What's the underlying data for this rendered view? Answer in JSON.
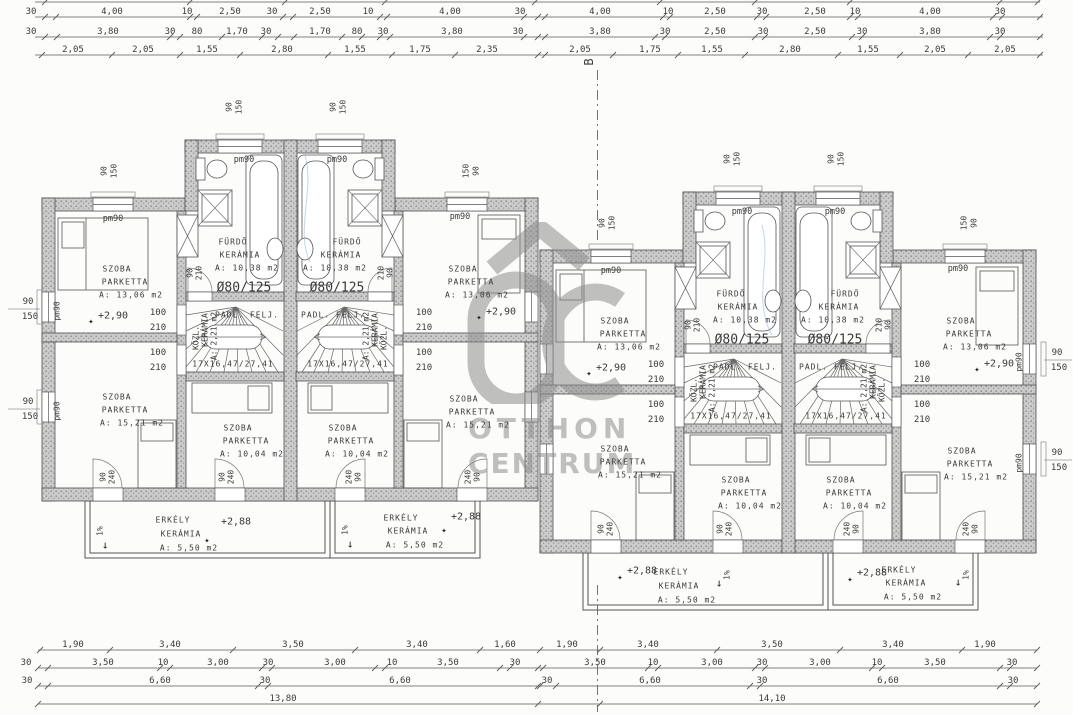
{
  "watermark": {
    "line1": "OTTHON",
    "line2": "CENTRUM"
  },
  "labels": [
    [
      "SZOBA",
      117,
      269,
      "rm"
    ],
    [
      "PARKETTA",
      125,
      282,
      "rm"
    ],
    [
      "A: 13,06 m2",
      131,
      295,
      "rm"
    ],
    [
      "+2,90",
      113,
      316,
      "lvl"
    ],
    [
      "✦",
      91,
      322,
      "star"
    ],
    [
      "SZOBA",
      117,
      397,
      "rm"
    ],
    [
      "PARKETTA",
      125,
      410,
      "rm"
    ],
    [
      "A: 15,21 m2",
      132,
      423,
      "rm"
    ],
    [
      "SZOBA",
      238,
      428,
      "rm"
    ],
    [
      "PARKETTA",
      246,
      441,
      "rm"
    ],
    [
      "A: 10,04 m2",
      252,
      454,
      "rm"
    ],
    [
      "FÜRDŐ",
      233,
      242,
      "rm"
    ],
    [
      "KERÁMIA",
      240,
      255,
      "rm"
    ],
    [
      "A: 10,38 m2",
      247,
      268,
      "rm"
    ],
    [
      "Ø80/125",
      244,
      288,
      "big"
    ],
    [
      "PADL. FELJ.",
      247,
      315,
      "rm"
    ],
    [
      "17X16,47/27,41",
      233,
      364,
      "rm"
    ],
    [
      "KÖZL.",
      196,
      338,
      "rot"
    ],
    [
      "KERÁMIA",
      205,
      330,
      "rot"
    ],
    [
      "A: 2,21 m2",
      214,
      336,
      "rot"
    ],
    [
      "pm90",
      113,
      219,
      "pm"
    ],
    [
      "pm90",
      244,
      160,
      "pm"
    ],
    [
      "SZOBA",
      463,
      269,
      "rm"
    ],
    [
      "PARKETTA",
      471,
      282,
      "rm"
    ],
    [
      "A: 13,06 m2",
      477,
      295,
      "rm"
    ],
    [
      "+2,90",
      501,
      312,
      "lvl"
    ],
    [
      "✦",
      479,
      318,
      "star"
    ],
    [
      "SZOBA",
      464,
      399,
      "rm"
    ],
    [
      "PARKETTA",
      472,
      412,
      "rm"
    ],
    [
      "A: 15,21 m2",
      478,
      425,
      "rm"
    ],
    [
      "SZOBA",
      343,
      428,
      "rm"
    ],
    [
      "PARKETTA",
      351,
      441,
      "rm"
    ],
    [
      "A: 10,04 m2",
      357,
      454,
      "rm"
    ],
    [
      "FÜRDŐ",
      347,
      242,
      "rm"
    ],
    [
      "KERÁMIA",
      341,
      255,
      "rm"
    ],
    [
      "A: 10,38 m2",
      335,
      268,
      "rm"
    ],
    [
      "Ø80/125",
      337,
      288,
      "big"
    ],
    [
      "PADL. FELJ.",
      333,
      315,
      "rm"
    ],
    [
      "17X16,47/27,41",
      348,
      364,
      "rm"
    ],
    [
      "KÖZL.",
      384,
      338,
      "rot"
    ],
    [
      "KERÁMIA",
      375,
      330,
      "rot"
    ],
    [
      "A: 2,21 m2",
      366,
      336,
      "rot"
    ],
    [
      "pm90",
      460,
      217,
      "pm"
    ],
    [
      "pm90",
      337,
      160,
      "pm"
    ],
    [
      "100",
      158,
      313,
      "dim"
    ],
    [
      "210",
      158,
      328,
      "dim"
    ],
    [
      "100",
      158,
      353,
      "dim"
    ],
    [
      "210",
      158,
      368,
      "dim"
    ],
    [
      "100",
      424,
      313,
      "dim"
    ],
    [
      "210",
      424,
      328,
      "dim"
    ],
    [
      "100",
      424,
      353,
      "dim"
    ],
    [
      "210",
      424,
      368,
      "dim"
    ],
    [
      "90",
      190,
      273,
      "rot"
    ],
    [
      "210",
      199,
      273,
      "rot"
    ],
    [
      "210",
      381,
      273,
      "rot"
    ],
    [
      "90",
      390,
      273,
      "rot"
    ],
    [
      "90",
      104,
      171,
      "rot"
    ],
    [
      "150",
      114,
      171,
      "rot"
    ],
    [
      "150",
      466,
      171,
      "rot"
    ],
    [
      "90",
      476,
      171,
      "rot"
    ],
    [
      "90",
      229,
      107,
      "rot"
    ],
    [
      "150",
      239,
      107,
      "rot"
    ],
    [
      "90",
      333,
      107,
      "rot"
    ],
    [
      "150",
      343,
      107,
      "rot"
    ],
    [
      "90",
      103,
      477,
      "rot"
    ],
    [
      "240",
      112,
      477,
      "rot"
    ],
    [
      "90",
      222,
      477,
      "rot"
    ],
    [
      "240",
      231,
      477,
      "rot"
    ],
    [
      "240",
      349,
      477,
      "rot"
    ],
    [
      "90",
      358,
      477,
      "rot"
    ],
    [
      "240",
      468,
      477,
      "rot"
    ],
    [
      "90",
      477,
      477,
      "rot"
    ],
    [
      "90",
      28,
      302,
      "dim"
    ],
    [
      "150",
      30,
      317,
      "dim"
    ],
    [
      "90",
      28,
      402,
      "dim"
    ],
    [
      "150",
      30,
      417,
      "dim"
    ],
    [
      "pm90",
      57,
      311,
      "rot"
    ],
    [
      "pm90",
      57,
      411,
      "rot"
    ],
    [
      "ERKÉLY",
      173,
      520,
      "rm"
    ],
    [
      "KERÁMIA",
      181,
      534,
      "rm"
    ],
    [
      "A: 5,50 m2",
      189,
      548,
      "rm"
    ],
    [
      "+2,88",
      236,
      522,
      "lvl"
    ],
    [
      "✦",
      207,
      541,
      "star"
    ],
    [
      "ERKÉLY",
      401,
      518,
      "rm"
    ],
    [
      "KERÁMIA",
      408,
      531,
      "rm"
    ],
    [
      "A: 5,50 m2",
      415,
      545,
      "rm"
    ],
    [
      "+2,88",
      466,
      517,
      "lvl"
    ],
    [
      "✦",
      444,
      531,
      "star"
    ],
    [
      "1%",
      100,
      531,
      "rot"
    ],
    [
      "↓",
      105,
      545,
      "arr"
    ],
    [
      "1%",
      345,
      530,
      "rot"
    ],
    [
      "↓",
      350,
      544,
      "arr"
    ],
    [
      "SZOBA",
      615,
      321,
      "rm"
    ],
    [
      "PARKETTA",
      623,
      334,
      "rm"
    ],
    [
      "A: 13,06 m2",
      629,
      347,
      "rm"
    ],
    [
      "+2,90",
      611,
      368,
      "lvl"
    ],
    [
      "✦",
      589,
      374,
      "star"
    ],
    [
      "SZOBA",
      615,
      449,
      "rm"
    ],
    [
      "PARKETTA",
      623,
      462,
      "rm"
    ],
    [
      "A: 15,21 m2",
      630,
      475,
      "rm"
    ],
    [
      "SZOBA",
      736,
      480,
      "rm"
    ],
    [
      "PARKETTA",
      744,
      493,
      "rm"
    ],
    [
      "A: 10,04 m2",
      750,
      506,
      "rm"
    ],
    [
      "FÜRDŐ",
      731,
      294,
      "rm"
    ],
    [
      "KERÁMIA",
      738,
      307,
      "rm"
    ],
    [
      "A: 10,38 m2",
      745,
      320,
      "rm"
    ],
    [
      "Ø80/125",
      742,
      340,
      "big"
    ],
    [
      "PADL. FELJ.",
      745,
      367,
      "rm"
    ],
    [
      "17X16,47/27,41",
      731,
      416,
      "rm"
    ],
    [
      "KÖZL.",
      694,
      390,
      "rot"
    ],
    [
      "KERÁMIA",
      703,
      382,
      "rot"
    ],
    [
      "A: 2,21 m2",
      712,
      388,
      "rot"
    ],
    [
      "pm90",
      611,
      271,
      "pm"
    ],
    [
      "pm90",
      742,
      212,
      "pm"
    ],
    [
      "SZOBA",
      961,
      321,
      "rm"
    ],
    [
      "PARKETTA",
      969,
      334,
      "rm"
    ],
    [
      "A: 13,06 m2",
      975,
      347,
      "rm"
    ],
    [
      "+2,90",
      999,
      364,
      "lvl"
    ],
    [
      "✦",
      977,
      370,
      "star"
    ],
    [
      "SZOBA",
      962,
      451,
      "rm"
    ],
    [
      "PARKETTA",
      970,
      464,
      "rm"
    ],
    [
      "A: 15,21 m2",
      976,
      477,
      "rm"
    ],
    [
      "SZOBA",
      841,
      480,
      "rm"
    ],
    [
      "PARKETTA",
      849,
      493,
      "rm"
    ],
    [
      "A: 10,04 m2",
      855,
      506,
      "rm"
    ],
    [
      "FÜRDŐ",
      845,
      294,
      "rm"
    ],
    [
      "KERÁMIA",
      839,
      307,
      "rm"
    ],
    [
      "A: 10,38 m2",
      833,
      320,
      "rm"
    ],
    [
      "Ø80/125",
      835,
      340,
      "big"
    ],
    [
      "PADL. FELJ.",
      831,
      367,
      "rm"
    ],
    [
      "17X16,47/27,41",
      846,
      416,
      "rm"
    ],
    [
      "KÖZL.",
      882,
      390,
      "rot"
    ],
    [
      "KERÁMIA",
      873,
      382,
      "rot"
    ],
    [
      "A: 2,21 m2",
      864,
      388,
      "rot"
    ],
    [
      "pm90",
      958,
      269,
      "pm"
    ],
    [
      "pm90",
      835,
      212,
      "pm"
    ],
    [
      "100",
      656,
      365,
      "dim"
    ],
    [
      "210",
      656,
      380,
      "dim"
    ],
    [
      "100",
      656,
      405,
      "dim"
    ],
    [
      "210",
      656,
      420,
      "dim"
    ],
    [
      "100",
      922,
      365,
      "dim"
    ],
    [
      "210",
      922,
      380,
      "dim"
    ],
    [
      "100",
      922,
      405,
      "dim"
    ],
    [
      "210",
      922,
      420,
      "dim"
    ],
    [
      "90",
      688,
      325,
      "rot"
    ],
    [
      "210",
      697,
      325,
      "rot"
    ],
    [
      "210",
      879,
      325,
      "rot"
    ],
    [
      "90",
      888,
      325,
      "rot"
    ],
    [
      "90",
      602,
      223,
      "rot"
    ],
    [
      "150",
      612,
      223,
      "rot"
    ],
    [
      "150",
      964,
      223,
      "rot"
    ],
    [
      "90",
      974,
      223,
      "rot"
    ],
    [
      "90",
      727,
      159,
      "rot"
    ],
    [
      "150",
      737,
      159,
      "rot"
    ],
    [
      "90",
      831,
      159,
      "rot"
    ],
    [
      "150",
      841,
      159,
      "rot"
    ],
    [
      "90",
      601,
      529,
      "rot"
    ],
    [
      "240",
      610,
      529,
      "rot"
    ],
    [
      "90",
      720,
      529,
      "rot"
    ],
    [
      "240",
      729,
      529,
      "rot"
    ],
    [
      "240",
      847,
      529,
      "rot"
    ],
    [
      "90",
      856,
      529,
      "rot"
    ],
    [
      "240",
      966,
      529,
      "rot"
    ],
    [
      "90",
      975,
      529,
      "rot"
    ],
    [
      "90",
      1057,
      353,
      "dim"
    ],
    [
      "150",
      1059,
      368,
      "dim"
    ],
    [
      "90",
      1057,
      453,
      "dim"
    ],
    [
      "150",
      1059,
      468,
      "dim"
    ],
    [
      "pm90",
      1019,
      362,
      "rot"
    ],
    [
      "pm90",
      1019,
      463,
      "rot"
    ],
    [
      "ERKÉLY",
      671,
      572,
      "rm"
    ],
    [
      "KERÁMIA",
      679,
      586,
      "rm"
    ],
    [
      "A: 5,50 m2",
      687,
      600,
      "rm"
    ],
    [
      "+2,88",
      642,
      571,
      "lvl"
    ],
    [
      "✦",
      620,
      578,
      "star"
    ],
    [
      "ERKÉLY",
      899,
      570,
      "rm"
    ],
    [
      "KERÁMIA",
      906,
      583,
      "rm"
    ],
    [
      "A: 5,50 m2",
      913,
      597,
      "rm"
    ],
    [
      "+2,88",
      872,
      573,
      "lvl"
    ],
    [
      "✦",
      850,
      580,
      "star"
    ],
    [
      "1%",
      727,
      575,
      "rot"
    ],
    [
      "↓",
      719,
      583,
      "arr"
    ],
    [
      "1%",
      966,
      575,
      "rot"
    ],
    [
      "↓",
      958,
      582,
      "arr"
    ],
    [
      "B",
      589,
      62,
      "rotB"
    ]
  ],
  "dim_rows": [
    {
      "y": -3,
      "x0": 35,
      "x1": 1040,
      "ticks": [
        45,
        190,
        285,
        385,
        535,
        660,
        755,
        850,
        1000,
        1038
      ],
      "labels": []
    },
    {
      "y": 12,
      "x0": 35,
      "x1": 1043,
      "ticks": [
        45,
        56,
        190,
        197,
        283,
        293,
        380,
        387,
        524,
        538,
        545,
        663,
        670,
        757,
        766,
        850,
        858,
        993,
        1002,
        1040
      ],
      "labels": [
        [
          "30",
          31
        ],
        [
          "4,00",
          112
        ],
        [
          "10",
          187
        ],
        [
          "2,50",
          230
        ],
        [
          "30",
          272
        ],
        [
          "2,50",
          320
        ],
        [
          "10",
          368
        ],
        [
          "4,00",
          450
        ],
        [
          "30",
          520
        ],
        [
          "4,00",
          600
        ],
        [
          "10",
          668
        ],
        [
          "2,50",
          715
        ],
        [
          "30",
          762
        ],
        [
          "2,50",
          815
        ],
        [
          "10",
          855
        ],
        [
          "4,00",
          930
        ],
        [
          "30",
          1000
        ]
      ]
    },
    {
      "y": 32,
      "x0": 35,
      "x1": 1043,
      "ticks": [
        45,
        57,
        170,
        180,
        222,
        262,
        278,
        294,
        342,
        362,
        380,
        390,
        524,
        538,
        545,
        655,
        665,
        755,
        765,
        852,
        862,
        990,
        1000,
        1040
      ],
      "labels": [
        [
          "30",
          31
        ],
        [
          "3,80",
          108
        ],
        [
          "30",
          170
        ],
        [
          "80",
          197
        ],
        [
          "1,70",
          237
        ],
        [
          "30",
          266
        ],
        [
          "1,70",
          320
        ],
        [
          "80",
          357
        ],
        [
          "30",
          383
        ],
        [
          "3,80",
          452
        ],
        [
          "30",
          518
        ],
        [
          "3,80",
          600
        ],
        [
          "30",
          665
        ],
        [
          "2,50",
          715
        ],
        [
          "30",
          763
        ],
        [
          "2,50",
          815
        ],
        [
          "30",
          862
        ],
        [
          "3,80",
          930
        ],
        [
          "30",
          1000
        ]
      ]
    },
    {
      "y": 50,
      "x0": 35,
      "x1": 1043,
      "ticks": [
        42,
        112,
        180,
        240,
        328,
        392,
        455,
        538,
        545,
        613,
        678,
        745,
        838,
        900,
        968,
        1040
      ],
      "labels": [
        [
          "2,05",
          73
        ],
        [
          "2,05",
          143
        ],
        [
          "1,55",
          207
        ],
        [
          "2,80",
          282
        ],
        [
          "1,55",
          355
        ],
        [
          "1,75",
          420
        ],
        [
          "2,35",
          487
        ],
        [
          "2,05",
          580
        ],
        [
          "1,75",
          650
        ],
        [
          "1,55",
          712
        ],
        [
          "2,80",
          790
        ],
        [
          "1,55",
          868
        ],
        [
          "2,05",
          935
        ],
        [
          "2,05",
          1005
        ]
      ]
    },
    {
      "y": 645,
      "x0": 38,
      "x1": 1037,
      "ticks": [
        40,
        110,
        233,
        355,
        480,
        540,
        600,
        717,
        840,
        962,
        1037
      ],
      "labels": [
        [
          "1,90",
          73
        ],
        [
          "3,40",
          170
        ],
        [
          "3,50",
          293
        ],
        [
          "3,40",
          417
        ],
        [
          "1,60",
          505
        ],
        [
          "1,90",
          567
        ],
        [
          "3,40",
          648
        ],
        [
          "3,50",
          772
        ],
        [
          "3,40",
          893
        ],
        [
          "1,90",
          985
        ]
      ]
    },
    {
      "y": 663,
      "x0": 38,
      "x1": 1037,
      "ticks": [
        38,
        48,
        160,
        170,
        262,
        272,
        375,
        385,
        500,
        510,
        538,
        543,
        648,
        658,
        755,
        765,
        872,
        882,
        1000,
        1010,
        1037
      ],
      "labels": [
        [
          "30",
          26
        ],
        [
          "3,50",
          103
        ],
        [
          "10",
          163
        ],
        [
          "3,00",
          218
        ],
        [
          "30",
          268
        ],
        [
          "3,00",
          335
        ],
        [
          "10",
          392
        ],
        [
          "3,50",
          448
        ],
        [
          "30",
          515
        ],
        [
          "3,50",
          595
        ],
        [
          "10",
          653
        ],
        [
          "3,00",
          712
        ],
        [
          "30",
          762
        ],
        [
          "3,00",
          820
        ],
        [
          "10",
          877
        ],
        [
          "3,50",
          935
        ],
        [
          "30",
          1012
        ]
      ]
    },
    {
      "y": 681,
      "x0": 38,
      "x1": 1037,
      "ticks": [
        38,
        48,
        258,
        268,
        538,
        540,
        556,
        750,
        760,
        1000,
        1010,
        1037
      ],
      "labels": [
        [
          "30",
          27
        ],
        [
          "6,60",
          160
        ],
        [
          "30",
          265
        ],
        [
          "6,60",
          400
        ],
        [
          "30",
          547
        ],
        [
          "6,60",
          650
        ],
        [
          "30",
          762
        ],
        [
          "6,60",
          888
        ],
        [
          "30",
          1013
        ]
      ]
    },
    {
      "y": 699,
      "x0": 38,
      "x1": 1037,
      "ticks": [
        38,
        538,
        600,
        1037
      ],
      "labels": [
        [
          "13,80",
          283
        ],
        [
          "14,10",
          772
        ]
      ]
    }
  ]
}
